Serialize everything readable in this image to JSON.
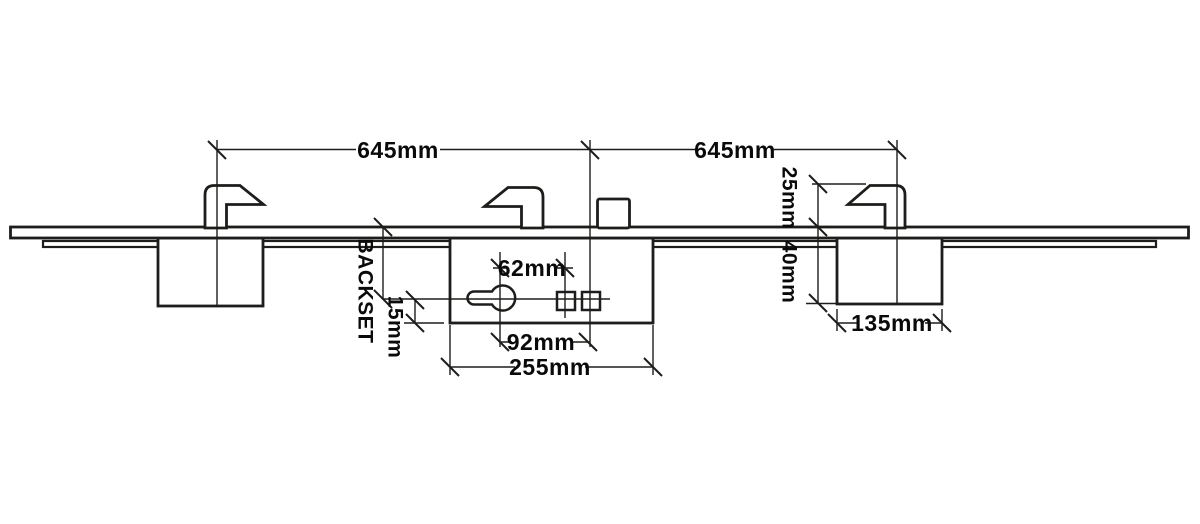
{
  "diagram": {
    "title": "Multipoint lock dimension drawing",
    "colors": {
      "line": "#1d1d1b",
      "text": "#0a0a0a",
      "background": "#ffffff"
    },
    "dimensions": {
      "left_span": "645mm",
      "right_span": "645mm",
      "hook_height": "25mm",
      "case_depth": "40mm",
      "gearbox_width": "135mm",
      "backset": "BACKSET",
      "centerline_offset": "15mm",
      "cylinder_to_spindle": "62mm",
      "cylinder_to_latch": "92mm",
      "case_width": "255mm"
    }
  }
}
